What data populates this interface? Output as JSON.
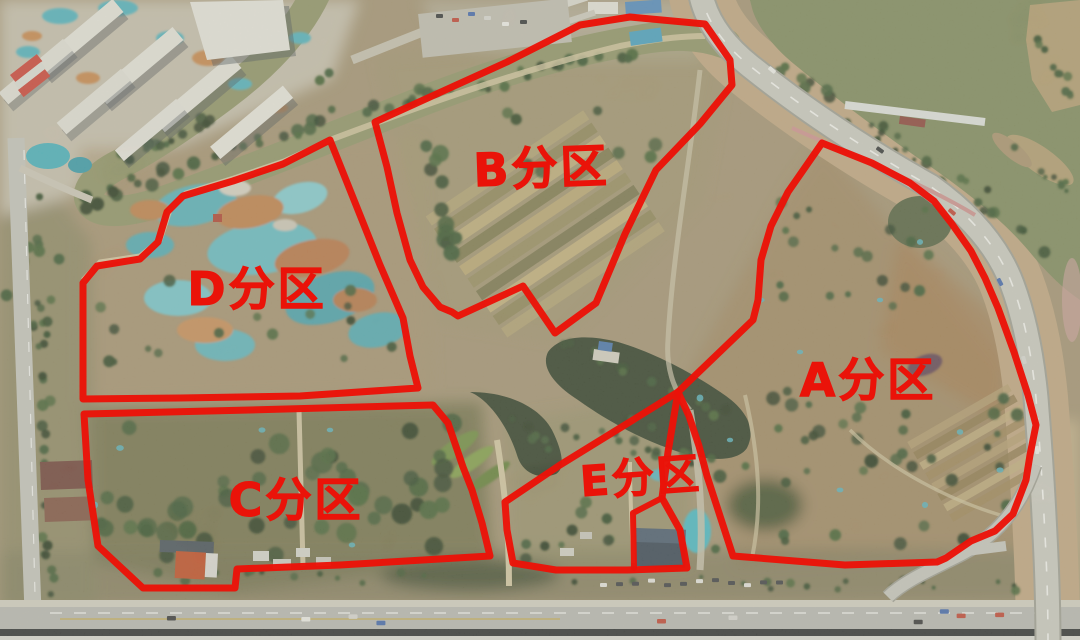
{
  "map": {
    "type": "satellite-aerial-annotated",
    "palette": {
      "overlay_red": "#ea1309",
      "river_water": "#8d9164",
      "lake_water": "#7b8659",
      "pond_water": "#263420",
      "land_base": "#a29070",
      "road_gray": "#ccccc5",
      "construction_teal": "#4fb0bd"
    }
  },
  "zones": [
    {
      "id": "A",
      "label": "A分区",
      "label_x": 868,
      "label_y": 396,
      "font_size": 46,
      "rotate": 0,
      "outline": [
        [
          822,
          143
        ],
        [
          872,
          163
        ],
        [
          910,
          183
        ],
        [
          934,
          201
        ],
        [
          952,
          224
        ],
        [
          971,
          251
        ],
        [
          985,
          278
        ],
        [
          998,
          308
        ],
        [
          1014,
          352
        ],
        [
          1028,
          395
        ],
        [
          1036,
          425
        ],
        [
          1030,
          455
        ],
        [
          1026,
          480
        ],
        [
          1013,
          514
        ],
        [
          995,
          531
        ],
        [
          971,
          541
        ],
        [
          946,
          558
        ],
        [
          937,
          562
        ],
        [
          845,
          565
        ],
        [
          733,
          556
        ],
        [
          721,
          519
        ],
        [
          707,
          476
        ],
        [
          699,
          446
        ],
        [
          689,
          416
        ],
        [
          678,
          392
        ],
        [
          753,
          320
        ],
        [
          758,
          300
        ],
        [
          761,
          260
        ],
        [
          771,
          226
        ],
        [
          788,
          192
        ]
      ]
    },
    {
      "id": "B",
      "label": "B分区",
      "label_x": 542,
      "label_y": 184,
      "font_size": 46,
      "rotate": -2,
      "outline": [
        [
          375,
          122
        ],
        [
          507,
          62
        ],
        [
          580,
          25
        ],
        [
          630,
          17
        ],
        [
          705,
          24
        ],
        [
          730,
          60
        ],
        [
          732,
          85
        ],
        [
          700,
          124
        ],
        [
          656,
          170
        ],
        [
          625,
          234
        ],
        [
          596,
          303
        ],
        [
          555,
          333
        ],
        [
          523,
          286
        ],
        [
          458,
          316
        ],
        [
          452,
          312
        ],
        [
          440,
          307
        ],
        [
          423,
          287
        ],
        [
          410,
          260
        ],
        [
          397,
          213
        ],
        [
          387,
          167
        ]
      ]
    },
    {
      "id": "C",
      "label": "C分区",
      "label_x": 296,
      "label_y": 516,
      "font_size": 46,
      "rotate": 0,
      "outline": [
        [
          84,
          414
        ],
        [
          250,
          410
        ],
        [
          433,
          405
        ],
        [
          448,
          423
        ],
        [
          463,
          467
        ],
        [
          472,
          490
        ],
        [
          482,
          523
        ],
        [
          490,
          556
        ],
        [
          340,
          565
        ],
        [
          237,
          569
        ],
        [
          235,
          588
        ],
        [
          143,
          588
        ],
        [
          98,
          546
        ],
        [
          88,
          480
        ]
      ]
    },
    {
      "id": "D",
      "label": "D分区",
      "label_x": 257,
      "label_y": 305,
      "font_size": 46,
      "rotate": 0,
      "outline": [
        [
          330,
          140
        ],
        [
          356,
          205
        ],
        [
          380,
          265
        ],
        [
          403,
          318
        ],
        [
          410,
          356
        ],
        [
          418,
          388
        ],
        [
          300,
          396
        ],
        [
          180,
          398
        ],
        [
          83,
          399
        ],
        [
          83,
          283
        ],
        [
          97,
          266
        ],
        [
          140,
          259
        ],
        [
          158,
          242
        ],
        [
          167,
          212
        ],
        [
          183,
          196
        ],
        [
          233,
          181
        ],
        [
          283,
          164
        ]
      ]
    },
    {
      "id": "E",
      "label": "E分区",
      "label_x": 642,
      "label_y": 492,
      "font_size": 42,
      "rotate": -4,
      "outline": [
        [
          505,
          502
        ],
        [
          560,
          465
        ],
        [
          620,
          428
        ],
        [
          678,
          392
        ],
        [
          668,
          452
        ],
        [
          662,
          498
        ],
        [
          680,
          530
        ],
        [
          687,
          568
        ],
        [
          627,
          570
        ],
        [
          556,
          570
        ],
        [
          513,
          563
        ],
        [
          507,
          530
        ]
      ],
      "inner_lines": [
        [
          [
            662,
            498
          ],
          [
            633,
            513
          ],
          [
            634,
            568
          ]
        ]
      ]
    }
  ]
}
